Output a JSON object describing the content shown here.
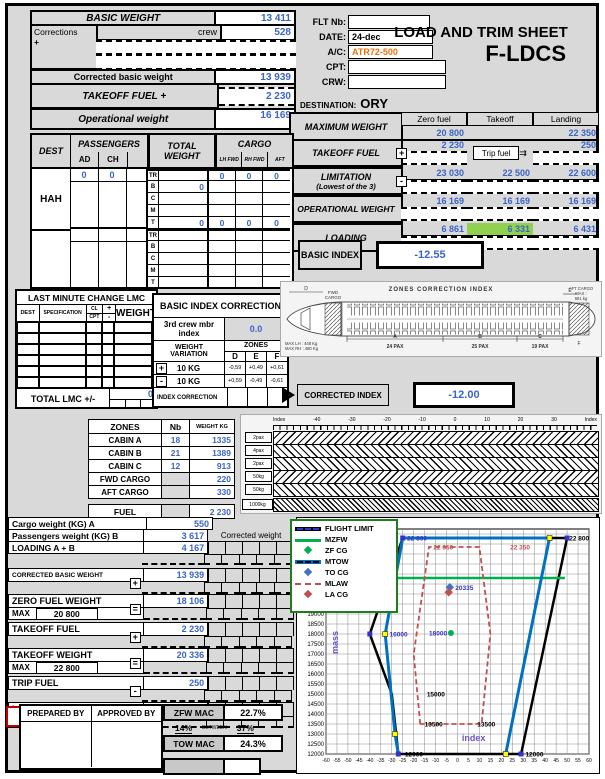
{
  "title": {
    "line1": "LOAD AND TRIM SHEET",
    "line2": "F-LDCS"
  },
  "flight": {
    "flt_label": "FLT Nb:",
    "date_label": "DATE:",
    "date": "24-dec",
    "ac_label": "A/C:",
    "ac": "ATR72-500",
    "cpt_label": "CPT:",
    "crw_label": "CRW:"
  },
  "destination": {
    "label": "DESTINATION:",
    "value": "ORY"
  },
  "basic": {
    "bw_label": "BASIC WEIGHT",
    "bw": "13 411",
    "corr_label": "Corrections",
    "plus": "+",
    "crew_label": "crew",
    "crew_val": "528",
    "cbw_label": "Corrected basic weight",
    "cbw": "13 939",
    "tof_label": "TAKEOFF FUEL +",
    "tof": "2 230",
    "ow_label": "Operational weight",
    "ow": "16 169"
  },
  "maxw": {
    "title": "MAXIMUM WEIGHT",
    "cols": [
      "Zero fuel",
      "Takeoff",
      "Landing"
    ],
    "max": [
      "20 800",
      "",
      "22 350"
    ],
    "tof": {
      "label": "TAKEOFF FUEL",
      "sym": "+",
      "zf": "2 230",
      "trip": "Trip fuel",
      "ld": "250"
    },
    "lim": {
      "label": "LIMITATION",
      "label2": "(Lowest of the 3)",
      "sym": "-",
      "vals": [
        "23 030",
        "22 500",
        "22 600"
      ]
    },
    "opw": {
      "label": "OPERATIONAL WEIGHT",
      "vals": [
        "16 169",
        "16 169",
        "16 169"
      ]
    },
    "load": {
      "label": "LOADING",
      "vals": [
        "6 861",
        "6 331",
        "6 431"
      ],
      "highlight_color": "#92d050"
    }
  },
  "pax": {
    "dest_h": "DEST",
    "pass_h": "PASSENGERS",
    "ad": "AD",
    "ch": "CH",
    "tw_h": "TOTAL WEIGHT",
    "cargo_h": "CARGO",
    "cargo_cols": [
      "LH FWD",
      "RH FWD",
      "AFT"
    ],
    "codes": [
      "TR",
      "B",
      "C",
      "M",
      "T"
    ],
    "dest": "HAH",
    "ad_v": "0",
    "ch_v": "0",
    "tr_cargo": [
      "0",
      "0",
      "0"
    ],
    "b_total": "0",
    "t_total": "0",
    "t_cargo": [
      "0",
      "0",
      "0"
    ]
  },
  "basic_index": {
    "label": "BASIC INDEX",
    "value": "-12.55"
  },
  "lmc": {
    "title": "LAST MINUTE CHANGE LMC",
    "dest": "DEST",
    "spec": "SPECIFICATION",
    "cl": "CL",
    "cpt": "CPT",
    "plus": "+",
    "minus": "-",
    "weight": "WEIGHT",
    "total_label": "TOTAL LMC +/-",
    "total": "0"
  },
  "bic": {
    "title": "BASIC INDEX CORRECTION",
    "crew_label": "3rd crew mbr index",
    "crew_val": "0.0",
    "wv1": "WEIGHT",
    "wv2": "VARIATION",
    "zones": "ZONES",
    "cols": [
      "D",
      "E",
      "F"
    ],
    "plus_sym": "+",
    "minus_sym": "-",
    "kg": "10 KG",
    "plus_vals": [
      "-0,59",
      "+0,49",
      "+0,61"
    ],
    "minus_vals": [
      "+0,59",
      "-0,49",
      "-0,61"
    ],
    "ic_label": "INDEX CORRECTION"
  },
  "corrected_index": {
    "label": "CORRECTED INDEX",
    "value": "-12.00"
  },
  "diagram": {
    "title": "ZONES CORRECTION INDEX",
    "fwd1": "FWD",
    "fwd2": "CARGO",
    "aft1": "AFT CARGO",
    "aft2": "MAX :",
    "aft3": "661 kg",
    "lh": "MAX LH : 448 Kg",
    "rh": "MAX RH : 480 Kg",
    "zones": [
      "A",
      "B",
      "C"
    ],
    "pax": [
      "24 PAX",
      "25 PAX",
      "19 PAX"
    ],
    "d": "D",
    "e": "E",
    "f": "F"
  },
  "zones_tbl": {
    "headers": [
      "ZONES",
      "Nb",
      "WEIGHT KG"
    ],
    "rows": [
      {
        "label": "CABIN A",
        "nb": "18",
        "w": "1335"
      },
      {
        "label": "CABIN B",
        "nb": "21",
        "w": "1389"
      },
      {
        "label": "CABIN C",
        "nb": "12",
        "w": "913"
      },
      {
        "label": "FWD CARGO",
        "nb": "",
        "w": "220"
      },
      {
        "label": "AFT CARGO",
        "nb": "",
        "w": "330"
      }
    ],
    "fuel_label": "FUEL",
    "fuel": "2 230"
  },
  "strips": {
    "axis_left": "Index",
    "axis_right": "Index",
    "ticks": [
      "-40",
      "-30",
      "-20",
      "-10",
      "0",
      "10",
      "20",
      "30"
    ],
    "tags": [
      "2pax",
      "4pax",
      "2pax",
      "50kg",
      "50kg",
      "1000kg"
    ]
  },
  "summary": {
    "a_label": "Cargo weight (KG) A",
    "a_val": "550",
    "b_label": "Passengers weight (KG) B",
    "b_val": "3 617",
    "corrected_header": "Corrected weight",
    "ab_label": "LOADING A + B",
    "ab_val": "4 167",
    "cbw_label": "CORRECTED BASIC WEIGHT",
    "cbw_sym": "+",
    "cbw_val": "13 939",
    "zfw_label": "ZERO FUEL WEIGHT",
    "zfw_max_l": "MAX",
    "zfw_max": "20 800",
    "zfw_sym": "=",
    "zfw_val": "18 106",
    "tof_label": "TAKEOFF FUEL",
    "tof_sym": "+",
    "tof_val": "2 230",
    "tow_label": "TAKEOFF WEIGHT",
    "tow_max_l": "MAX",
    "tow_max": "22 800",
    "tow_sym": "=",
    "tow_val": "20 336",
    "trip_label": "TRIP FUEL",
    "trip_sym": "-",
    "trip_val": "250",
    "law_label": "LANDING WEIGHT",
    "law_max_l": "MAX",
    "law_max": "22 350",
    "law_sym": "=",
    "law_val": "20 086"
  },
  "legend": [
    {
      "label": "FLIGHT LIMIT",
      "color": "#000000",
      "style": "limit"
    },
    {
      "label": "MZFW",
      "color": "#00b050",
      "style": "line"
    },
    {
      "label": "ZF CG",
      "color": "#00b050",
      "style": "marker"
    },
    {
      "label": "MTOW",
      "color": "#0070c0",
      "style": "thick"
    },
    {
      "label": "TO CG",
      "color": "#4472c4",
      "style": "marker"
    },
    {
      "label": "MLAW",
      "color": "#c0504d",
      "style": "dash"
    },
    {
      "label": "LA CG",
      "color": "#c0504d",
      "style": "marker"
    }
  ],
  "footer": {
    "prepared": "PREPARED BY",
    "approved": "APPROVED BY",
    "zfw_mac_l": "ZFW MAC",
    "zfw_mac": "22.7%",
    "between_left": "14%",
    "between_mid": "BETWEEN",
    "between_right": "37%",
    "tow_mac_l": "TOW MAC",
    "tow_mac": "24.3%"
  },
  "chart_data": {
    "type": "line",
    "title": "",
    "xlabel": "index",
    "ylabel": "mass",
    "xlim": [
      -60,
      60
    ],
    "xtick_step": 5,
    "ylim": [
      12000,
      23250
    ],
    "ytick_step": 500,
    "ytick_label_max": 20500,
    "grid": true,
    "legend_position": "top-left",
    "series": [
      {
        "name": "FLIGHT LIMIT",
        "color": "#000000",
        "width": 2.5,
        "dash": null,
        "points": [
          [
            -40,
            18000
          ],
          [
            -25,
            22800
          ],
          [
            50,
            22800
          ],
          [
            29,
            12000
          ],
          [
            -27,
            12000
          ],
          [
            -30,
            15000
          ],
          [
            -40,
            18000
          ]
        ]
      },
      {
        "name": "MZFW",
        "color": "#00b050",
        "width": 2.5,
        "dash": null,
        "points": [
          [
            -33,
            20800
          ],
          [
            49,
            20800
          ]
        ]
      },
      {
        "name": "MTOW",
        "color": "#0070c0",
        "width": 3,
        "dash": null,
        "points": [
          [
            -27,
            12000
          ],
          [
            -28.5,
            13000
          ],
          [
            -33,
            18000
          ],
          [
            -25,
            22800
          ],
          [
            42,
            22800
          ],
          [
            22,
            12000
          ]
        ]
      },
      {
        "name": "MLAW",
        "color": "#c0504d",
        "width": 1.8,
        "dash": "5,3",
        "points": [
          [
            -17,
            13500
          ],
          [
            -20,
            17000
          ],
          [
            -13,
            22350
          ],
          [
            10,
            22350
          ],
          [
            15,
            18000
          ],
          [
            11,
            13500
          ],
          [
            -17,
            13500
          ]
        ]
      }
    ],
    "cg_points": [
      {
        "name": "ZF CG",
        "x": -3,
        "y": 18050,
        "color": "#00b050",
        "shape": "circle"
      },
      {
        "name": "TO CG",
        "x": -3.5,
        "y": 20336,
        "color": "#4472c4",
        "shape": "diamond"
      },
      {
        "name": "LA CG",
        "x": -4,
        "y": 20086,
        "color": "#c0504d",
        "shape": "diamond"
      }
    ],
    "vertex_markers": {
      "yellow": [
        [
          -33,
          18000
        ],
        [
          -28.5,
          13000
        ],
        [
          42,
          22800
        ],
        [
          22,
          12000
        ]
      ],
      "purple": [
        [
          -40,
          18000
        ],
        [
          -25,
          22800
        ],
        [
          50,
          22800
        ],
        [
          -27,
          12000
        ],
        [
          29,
          12000
        ]
      ]
    },
    "annotations": [
      {
        "x": -23,
        "y": 22800,
        "text": "22 800",
        "color": "#3333cc"
      },
      {
        "x": 51,
        "y": 22800,
        "text": "22 800",
        "color": "#000000"
      },
      {
        "x": -11,
        "y": 22350,
        "text": "22 350",
        "color": "#c0504d"
      },
      {
        "x": 24,
        "y": 22350,
        "text": "22 350",
        "color": "#c0504d"
      },
      {
        "x": -1,
        "y": 20336,
        "text": "20335",
        "color": "#3333cc"
      },
      {
        "x": -31,
        "y": 18000,
        "text": "16000",
        "color": "#3333cc"
      },
      {
        "x": -13,
        "y": 18050,
        "text": "18000",
        "color": "#3333cc"
      },
      {
        "x": -14,
        "y": 15000,
        "text": "15000",
        "color": "#000000"
      },
      {
        "x": -15,
        "y": 13500,
        "text": "13500",
        "color": "#000000"
      },
      {
        "x": 9,
        "y": 13500,
        "text": "13500",
        "color": "#000000"
      },
      {
        "x": -24,
        "y": 12000,
        "text": "12000",
        "color": "#000000"
      },
      {
        "x": 31,
        "y": 12000,
        "text": "12000",
        "color": "#000000"
      }
    ]
  }
}
